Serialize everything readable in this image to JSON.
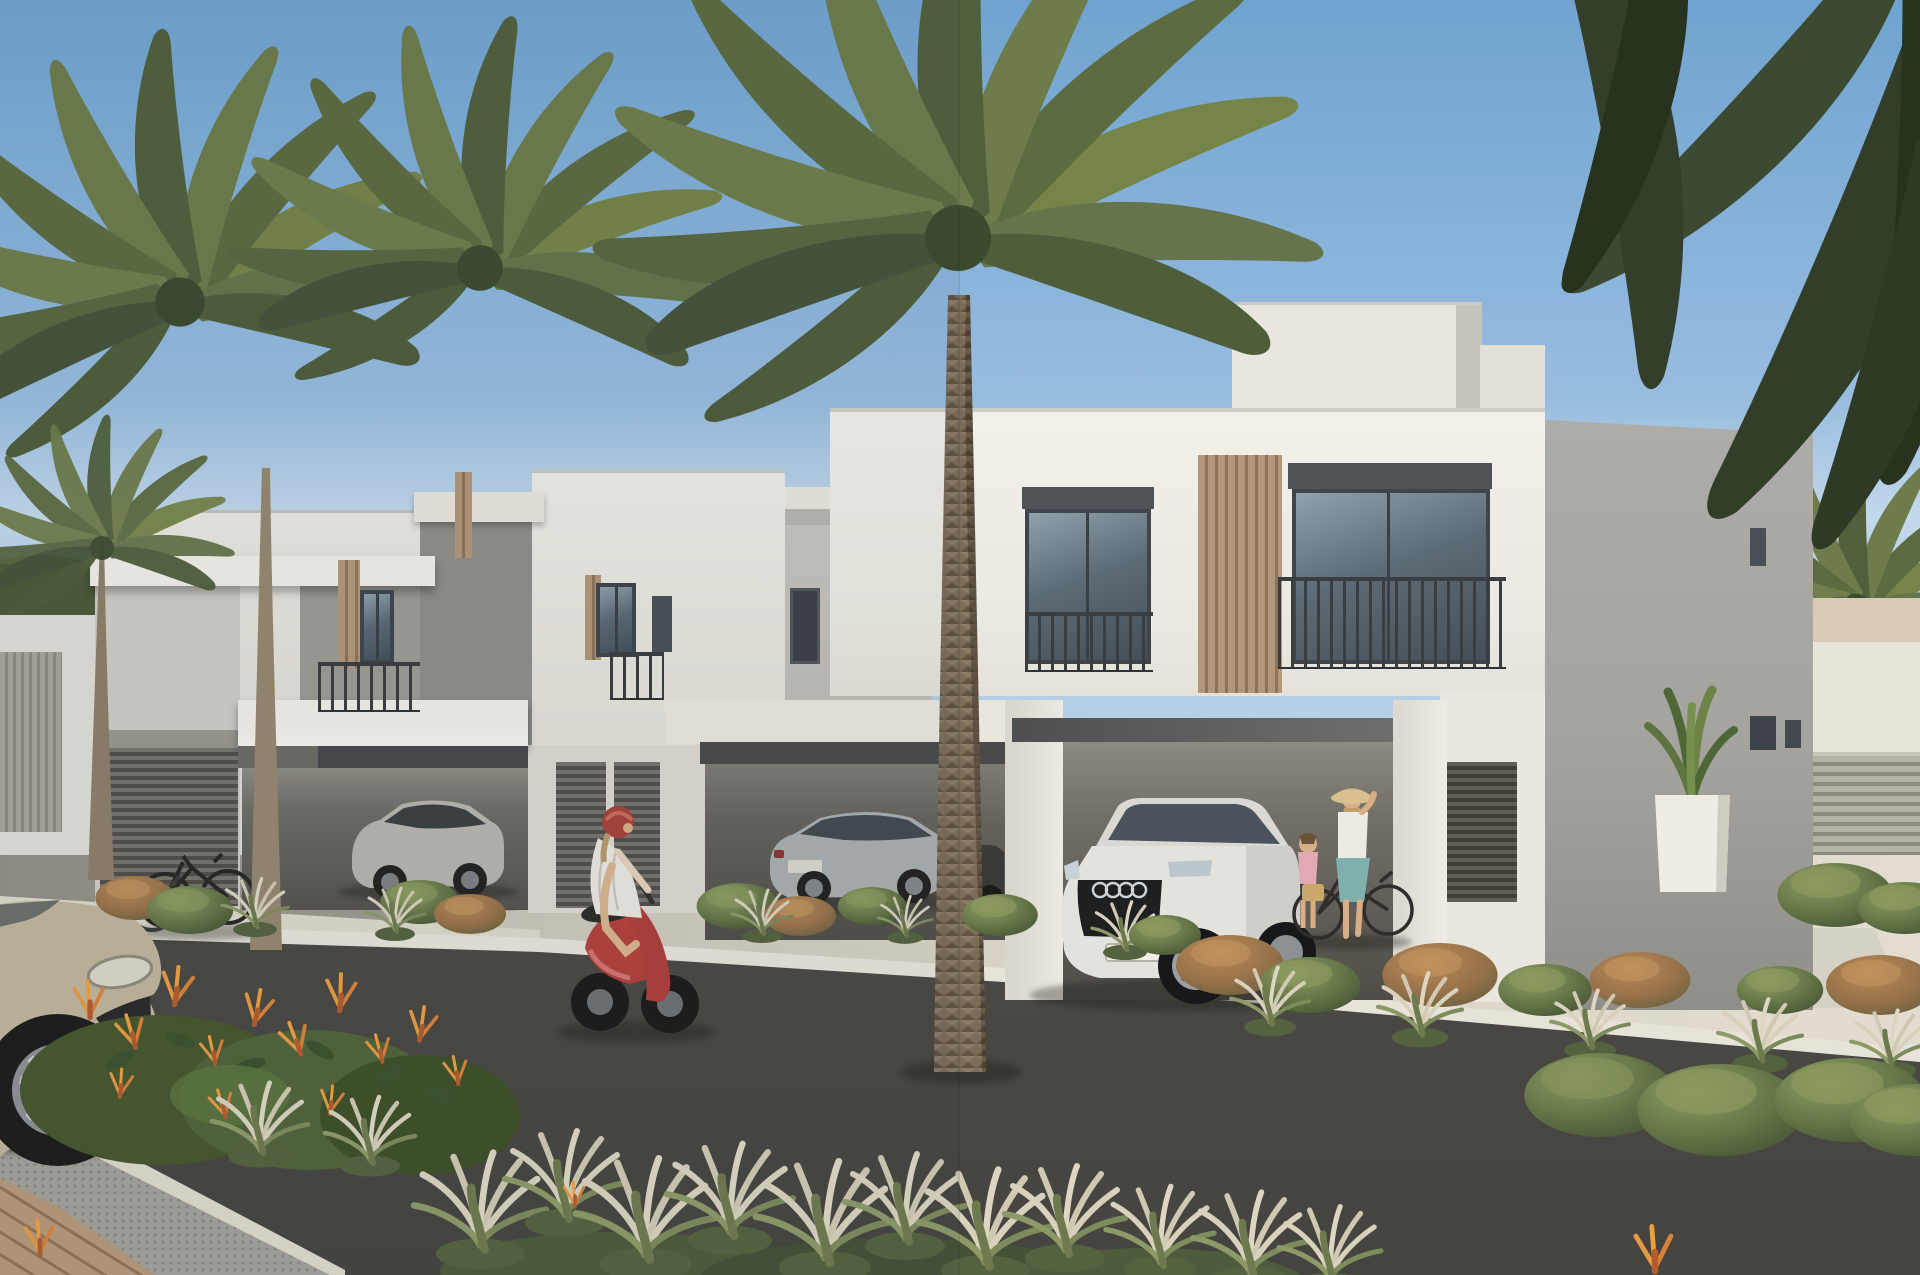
{
  "meta": {
    "title": "Modern townhouse community — exterior architectural rendering",
    "time_of_day": "bright daylight",
    "visible_text": "none"
  },
  "palette": {
    "sky_top": "#6fa3cf",
    "sky_horizon": "#e4edf4",
    "wall_sunlit": "#efede6",
    "wall_shadow": "#a8a6a1",
    "wall_recessed": "#9c9b95",
    "slat_wood": "#b3977a",
    "window_glass": "#5d6b76",
    "window_frame": "#3f454b",
    "carport_beam": "#46474b",
    "carport_shade": "#5a5852",
    "road_asphalt": "#535149",
    "curb_white": "#e7e3d8",
    "pavement": "#d7d2c6",
    "gravel": "#a3a19a",
    "brick_paver": "#b69879",
    "palm_light": "#758449",
    "palm_dark": "#4e5d3a",
    "frond_corner": "#323e29",
    "bush_green": "#5f7044",
    "bush_rust": "#96714a",
    "grass_plume": "#d8d2bd",
    "flower_orange": "#e59a43",
    "scooter_red": "#b2423d",
    "helmet_red": "#a8423a",
    "audi_white": "#e3e2dd",
    "sedan_silver": "#a9aeae",
    "suv_silver": "#b6b4ad",
    "car_beige": "#c0b59c",
    "skirt_teal": "#7fb0ad",
    "child_pink": "#e0a9b4",
    "hat_straw": "#d9c08d"
  },
  "labels": {
    "scene": "Sunlit street scene of a modern white townhouse community with palms",
    "sky": "Clear blue sky",
    "bg_left": "Neighbouring white villas behind trees",
    "bg_right": "Neighbouring villa, palm and timber fence",
    "left_building": "Two-storey white townhouse with carport and louvred garage",
    "mid_building": "Recessed townhouse facade between villas",
    "right_building": "Two-storey white townhouse with double carport and balconies",
    "central_palm": "Tall date palm in front of the houses",
    "left_palms": "Pair of date palms on the left",
    "corner_fronds": "Dark palm fronds overhanging the top right corner",
    "bg_palm_right": "Small palm behind the right fence",
    "road": "Dark asphalt street",
    "curb": "White kerb line along the street",
    "pavement": "Light paved driveways and sidewalk",
    "gravel_strip": "Gravel margin at lower left",
    "brick_path": "Brick paved corner walkway",
    "scooter_rider": "Woman in white dress and red helmet riding a red scooter",
    "audi_suv": "White SUV parked in the right carport",
    "silver_sedan": "Silver sedan parked in the middle carport",
    "silver_suv": "Silver SUV parked in the left carport",
    "dark_car": "Dark car behind the palm trunk",
    "beige_car": "Beige SUV nose in the near foreground",
    "woman_bicycle": "Woman with sun hat standing with a bicycle",
    "child": "Child in pink beside the SUV",
    "parked_bicycles": "Bicycles leaning by the left garage",
    "flower_bed": "Bird-of-paradise bushes with orange flowers",
    "grass_row": "Fountain grass with pale plumes",
    "planting_beds": "Low shrub planting beds",
    "potted_plant": "Leafy plant in a white cube planter",
    "fence": "Horizontal timber slat fence",
    "left_trees": "Dense green trees at the far left"
  }
}
